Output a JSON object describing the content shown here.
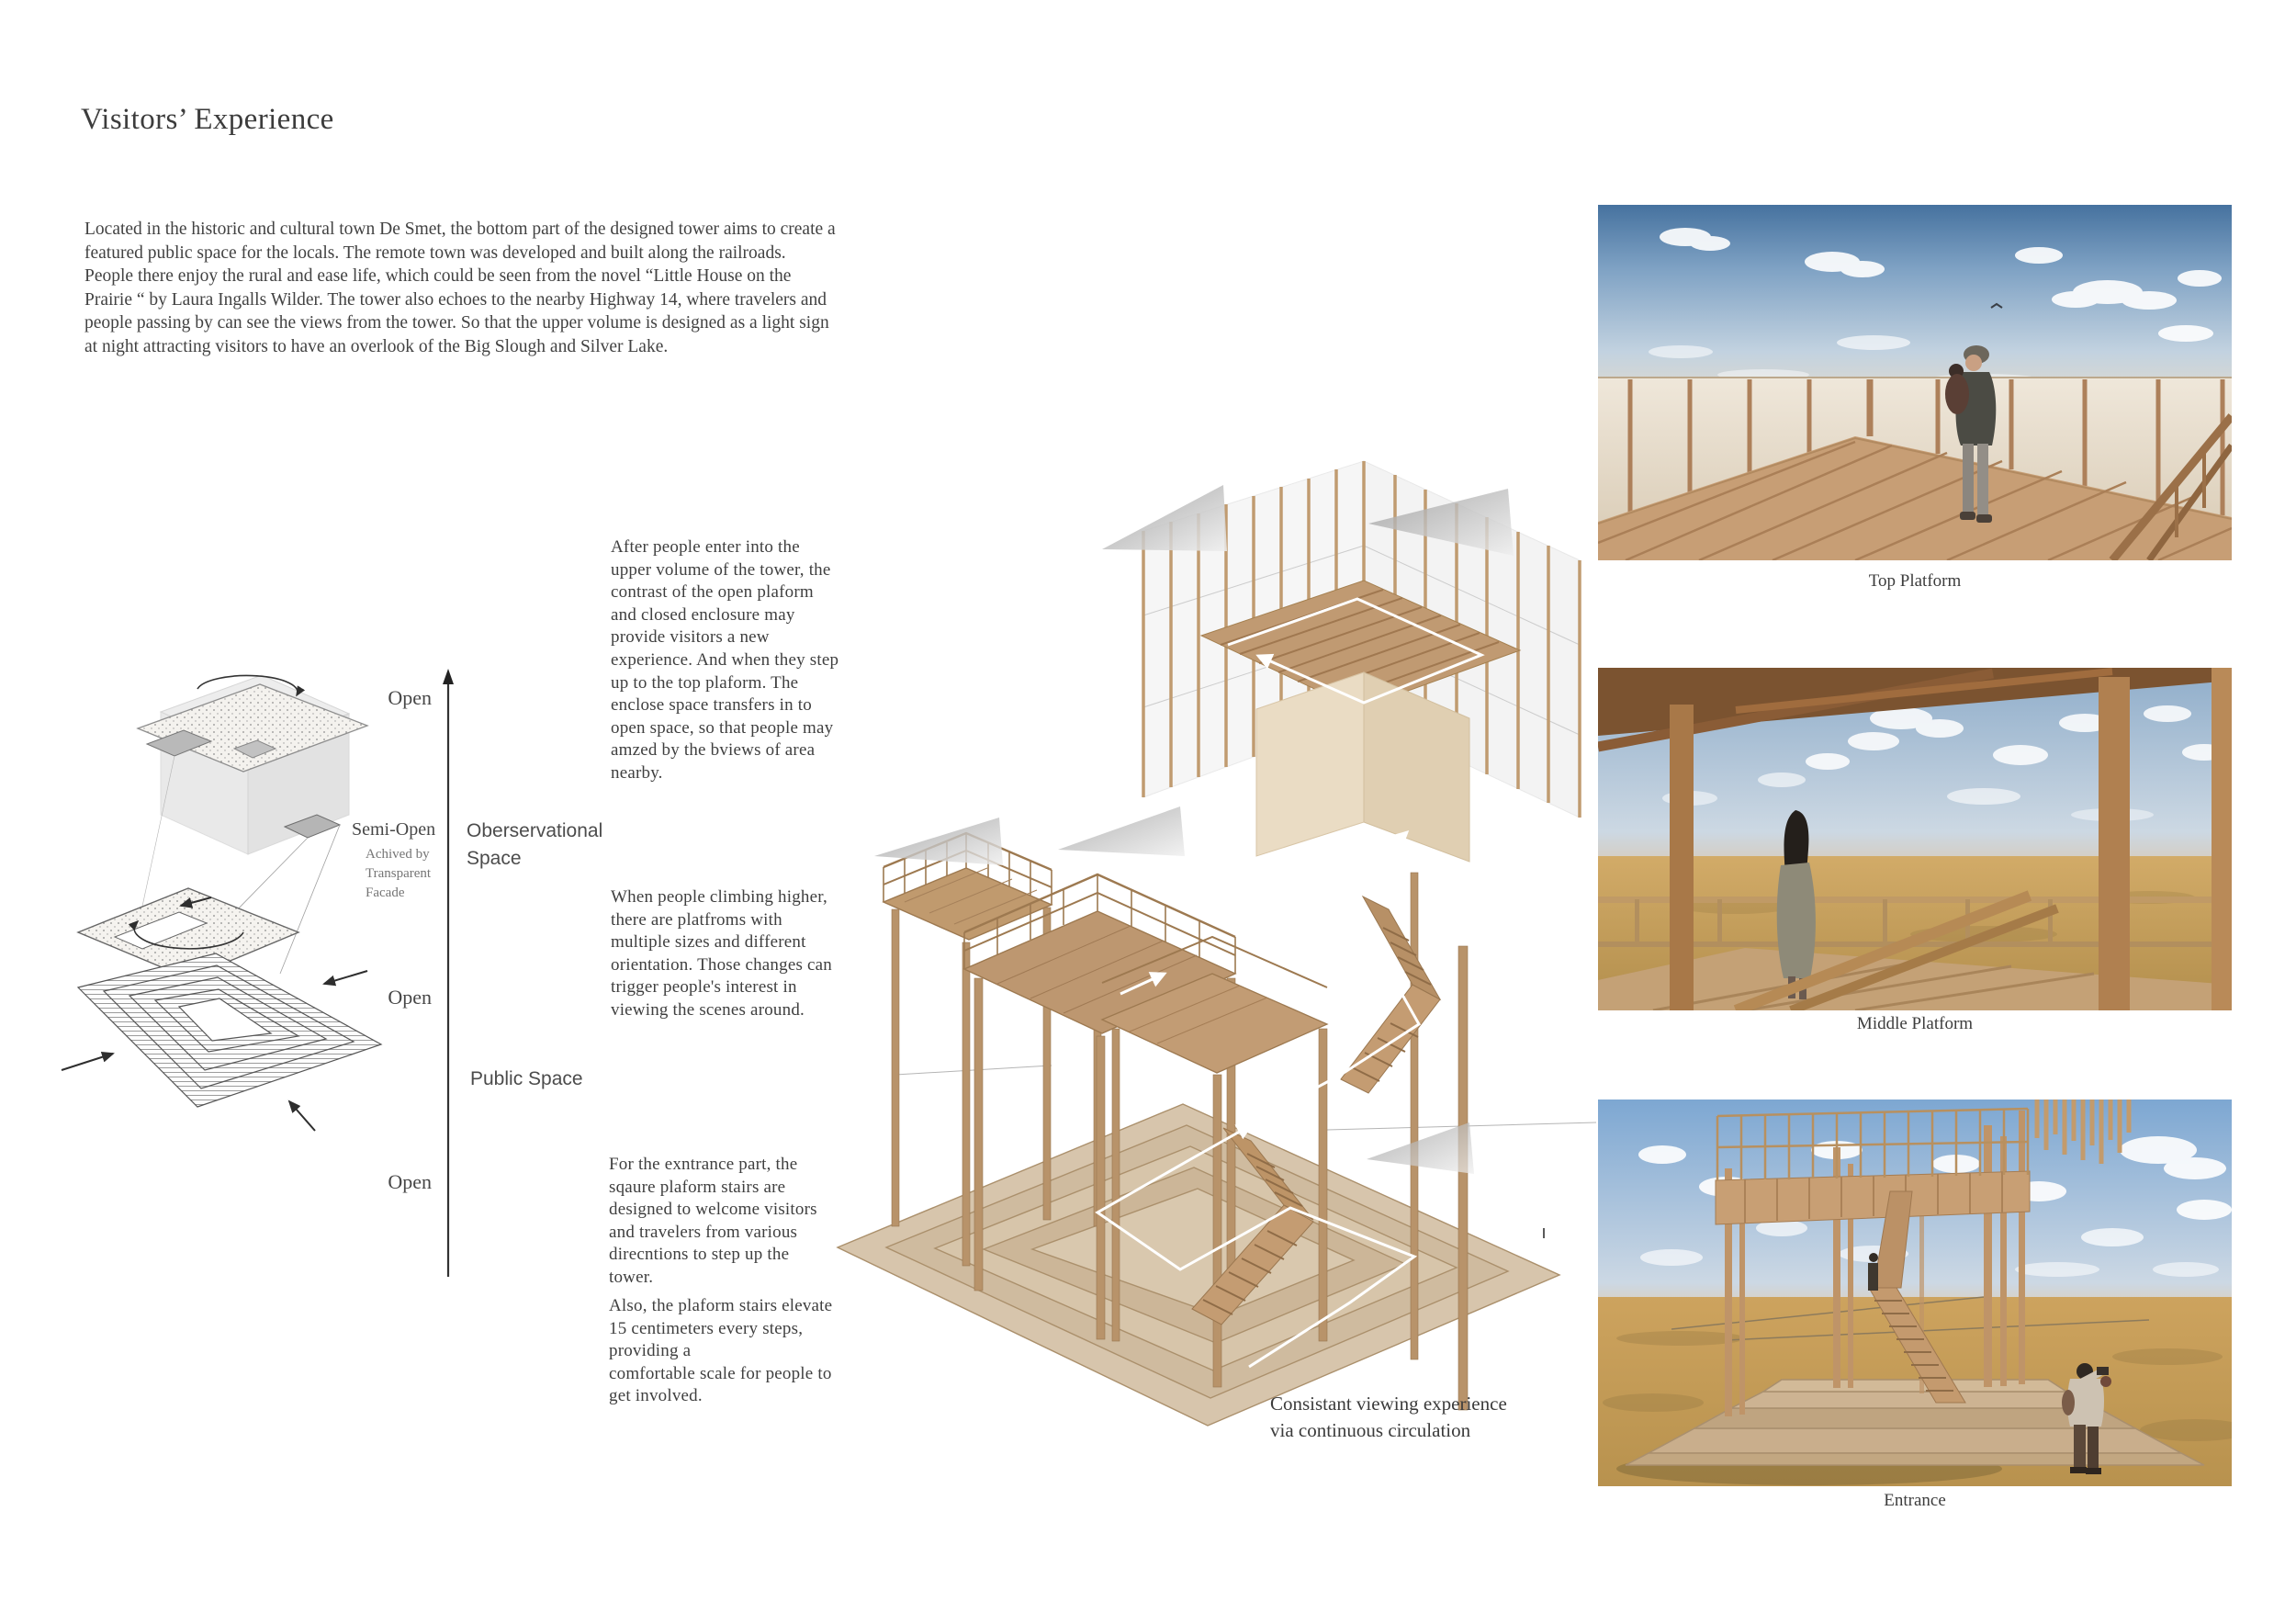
{
  "page": {
    "title": "Visitors’ Experience",
    "intro": "Located in the historic and cultural town De Smet, the bottom part of  the designed tower aims to create a featured public space for the locals. The remote town was developed and built along the railroads. People there enjoy the rural and ease life, which could be seen from the novel “Little House on the Prairie “ by Laura Ingalls Wilder. The tower also echoes to the nearby Highway 14, where travelers and people passing by can see the views from the tower. So that the upper volume is designed as a light sign at night attracting visitors to have an overlook of  the Big Slough and Silver Lake."
  },
  "diagram": {
    "axis_top_label": "Open",
    "semi_open_label": "Semi-Open",
    "semi_open_note": "Achived by\nTransparent\nFacade",
    "axis_mid_label": "Open",
    "axis_bottom_label": "Open",
    "zone_observational": "Oberservational Space",
    "zone_public": "Public Space"
  },
  "annotations": {
    "upper": "After people enter into the upper volume of  the tower, the contrast of  the open plaform and closed enclosure may provide visitors a new experience. And when  they step up to the top plaform. The enclose space transfers in to open space, so that people may amzed by the bviews of area nearby.",
    "middle": "When people climbing higher, there are platfroms with multiple sizes and different orientation. Those changes can trigger people's interest in viewing the scenes around.",
    "entrance": "For the exntrance part, the sqaure plaform stairs are designed to welcome visitors and travelers from various direcntions to step up the tower.",
    "steps": "Also, the plaform stairs elevate 15 centimeters every steps, providing a\ncomfortable scale for people to get involved."
  },
  "axon": {
    "caption": "Consistant viewing experience\nvia continuous circulation"
  },
  "photos": [
    {
      "caption": "Top Platform"
    },
    {
      "caption": "Middle Platform"
    },
    {
      "caption": "Entrance"
    }
  ],
  "palette": {
    "wood_light": "#d8c6ad",
    "wood_mid": "#c09a6e",
    "wood_dark": "#8a5c36",
    "sky_blue": "#5b85b8",
    "prairie_gold": "#c9a05e",
    "text": "#3f3f3f"
  }
}
